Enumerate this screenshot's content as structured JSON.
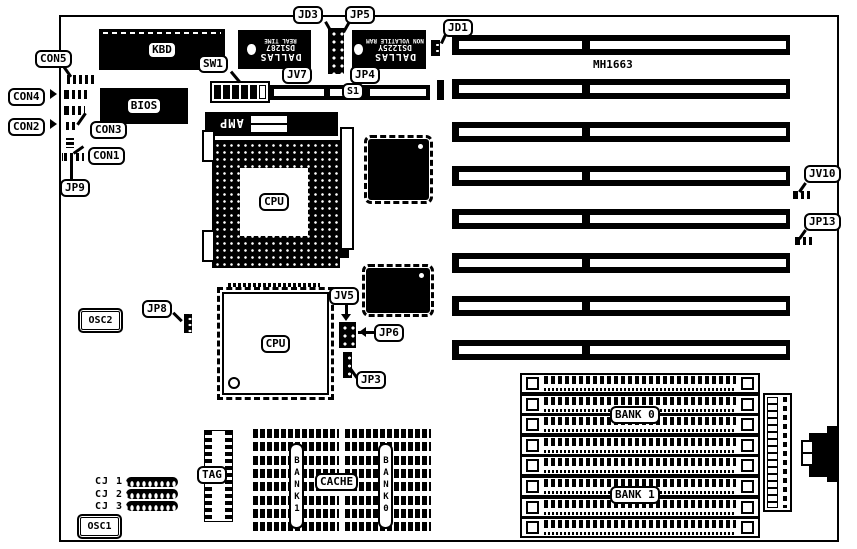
{
  "diagram": {
    "board_name": "MH1663",
    "labels": {
      "kbd": "KBD",
      "bios": "BIOS",
      "sw1": "SW1",
      "s1": "S1",
      "jd3": "JD3",
      "jp5": "JP5",
      "jd1": "JD1",
      "jv7": "JV7",
      "jp4": "JP4",
      "con5": "CON5",
      "con4": "CON4",
      "con3": "CON3",
      "con2": "CON2",
      "con1": "CON1",
      "jp9": "JP9",
      "jp8": "JP8",
      "jp6": "JP6",
      "jp3": "JP3",
      "jv5": "JV5",
      "jv10": "JV10",
      "jp13": "JP13",
      "osc1": "OSC1",
      "osc2": "OSC2",
      "tag": "TAG",
      "amp": "AMP",
      "cpu_socket": "CPU",
      "cpu_qfp": "CPU",
      "cache": "CACHE",
      "cache_bank1": "BANK1",
      "cache_bank0": "BANK0",
      "simm_bank0": "BANK 0",
      "simm_bank1": "BANK 1",
      "cj1": "CJ 1",
      "cj2": "CJ 2",
      "cj3": "CJ 3"
    },
    "chips": {
      "rtc": {
        "brand": "DALLAS",
        "part": "DS1287",
        "desc": "REAL TIME"
      },
      "nvram": {
        "brand": "DALLAS",
        "part": "DS1225Y",
        "desc": "NON VOLATILE RAM"
      }
    },
    "isa_slots": {
      "count": 8
    },
    "simm_sockets": {
      "count": 8,
      "rows_per_bank": 4
    },
    "cj_headers": {
      "count": 3
    },
    "colors": {
      "ink": "#000000",
      "paper": "#ffffff"
    }
  }
}
